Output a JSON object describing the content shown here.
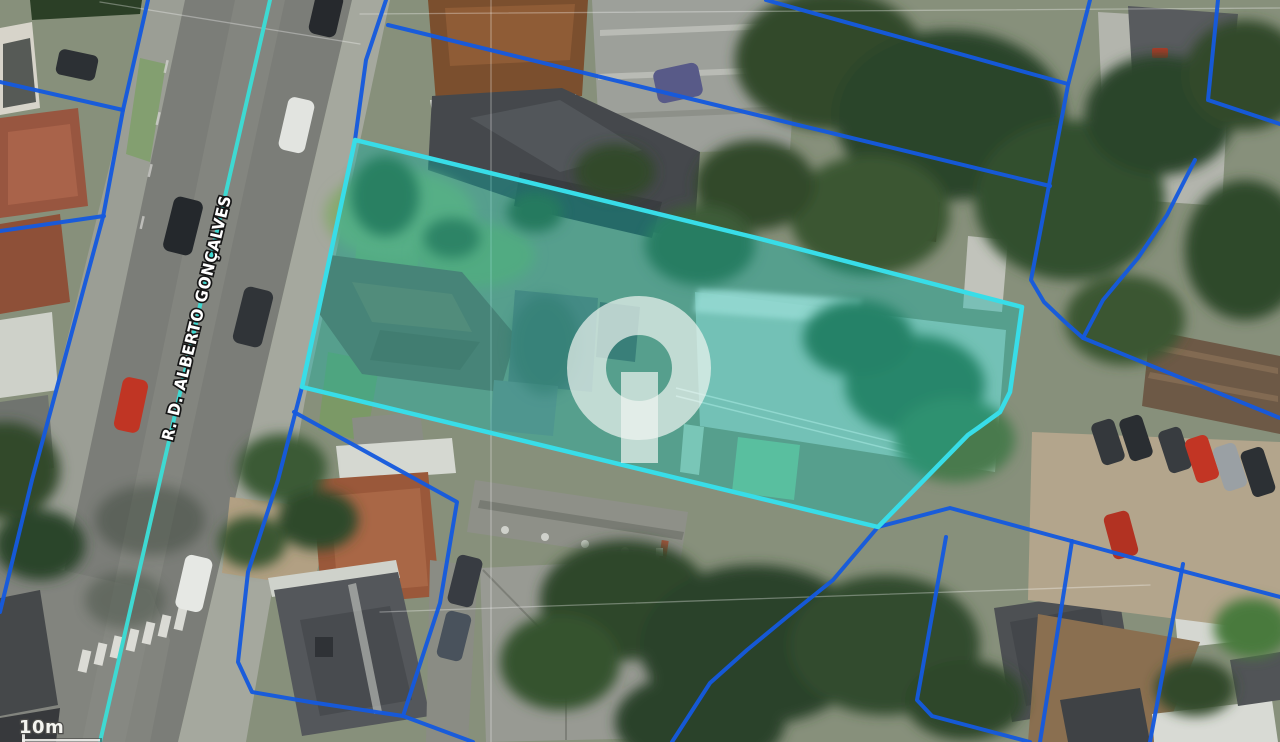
{
  "map": {
    "street": {
      "label": "R. D. ALBERTO GONÇALVES"
    },
    "scale": {
      "label": "10m"
    },
    "colors": {
      "cadastral_line": "#155ade",
      "street_centerline": "#3ed9d2",
      "parcel_border": "#38dde8",
      "parcel_fill": "rgba(0,187,175,0.36)",
      "hairline": "rgba(255,255,255,0.32)",
      "watermark": "#eff5f1"
    },
    "street_centerline": [
      [
        270,
        0
      ],
      [
        100,
        742
      ]
    ],
    "highlighted_parcel": {
      "points": [
        [
          355,
          140
        ],
        [
          753,
          237
        ],
        [
          1022,
          307
        ],
        [
          1010,
          392
        ],
        [
          1000,
          412
        ],
        [
          978,
          428
        ],
        [
          968,
          435
        ],
        [
          878,
          527
        ],
        [
          302,
          387
        ]
      ]
    },
    "cadastral_lines": [
      [
        [
          148,
          0
        ],
        [
          123,
          110
        ],
        [
          103,
          217
        ],
        [
          32,
          480
        ],
        [
          0,
          612
        ]
      ],
      [
        [
          0,
          82
        ],
        [
          123,
          110
        ]
      ],
      [
        [
          0,
          231
        ],
        [
          104,
          216
        ]
      ],
      [
        [
          386,
          0
        ],
        [
          366,
          60
        ],
        [
          355,
          140
        ]
      ],
      [
        [
          302,
          387
        ],
        [
          278,
          480
        ],
        [
          248,
          572
        ],
        [
          238,
          662
        ],
        [
          252,
          692
        ],
        [
          310,
          702
        ],
        [
          403,
          716
        ],
        [
          473,
          742
        ]
      ],
      [
        [
          294,
          412
        ],
        [
          457,
          502
        ],
        [
          440,
          603
        ],
        [
          403,
          716
        ]
      ],
      [
        [
          388,
          25
        ],
        [
          720,
          106
        ],
        [
          1050,
          186
        ]
      ],
      [
        [
          766,
          0
        ],
        [
          1068,
          84
        ]
      ],
      [
        [
          1090,
          0
        ],
        [
          1068,
          85
        ],
        [
          1050,
          180
        ],
        [
          1031,
          280
        ],
        [
          1044,
          302
        ],
        [
          1065,
          322
        ],
        [
          1083,
          338
        ],
        [
          1280,
          418
        ]
      ],
      [
        [
          1195,
          160
        ],
        [
          1167,
          215
        ],
        [
          1138,
          258
        ],
        [
          1103,
          300
        ],
        [
          1083,
          338
        ]
      ],
      [
        [
          1218,
          0
        ],
        [
          1208,
          100
        ],
        [
          1280,
          124
        ]
      ],
      [
        [
          878,
          527
        ],
        [
          950,
          508
        ],
        [
          1130,
          557
        ],
        [
          1280,
          597
        ]
      ],
      [
        [
          946,
          537
        ],
        [
          917,
          700
        ],
        [
          932,
          716
        ],
        [
          1030,
          742
        ]
      ],
      [
        [
          1072,
          541
        ],
        [
          1040,
          742
        ]
      ],
      [
        [
          1183,
          564
        ],
        [
          1150,
          742
        ]
      ],
      [
        [
          878,
          527
        ],
        [
          833,
          580
        ],
        [
          787,
          617
        ],
        [
          747,
          650
        ],
        [
          710,
          683
        ],
        [
          672,
          742
        ]
      ]
    ],
    "hairlines": [
      [
        [
          360,
          14
        ],
        [
          1280,
          8
        ]
      ],
      [
        [
          100,
          2
        ],
        [
          360,
          44
        ]
      ],
      [
        [
          491,
          0
        ],
        [
          491,
          742
        ]
      ],
      [
        [
          380,
          612
        ],
        [
          1150,
          585
        ]
      ]
    ]
  }
}
